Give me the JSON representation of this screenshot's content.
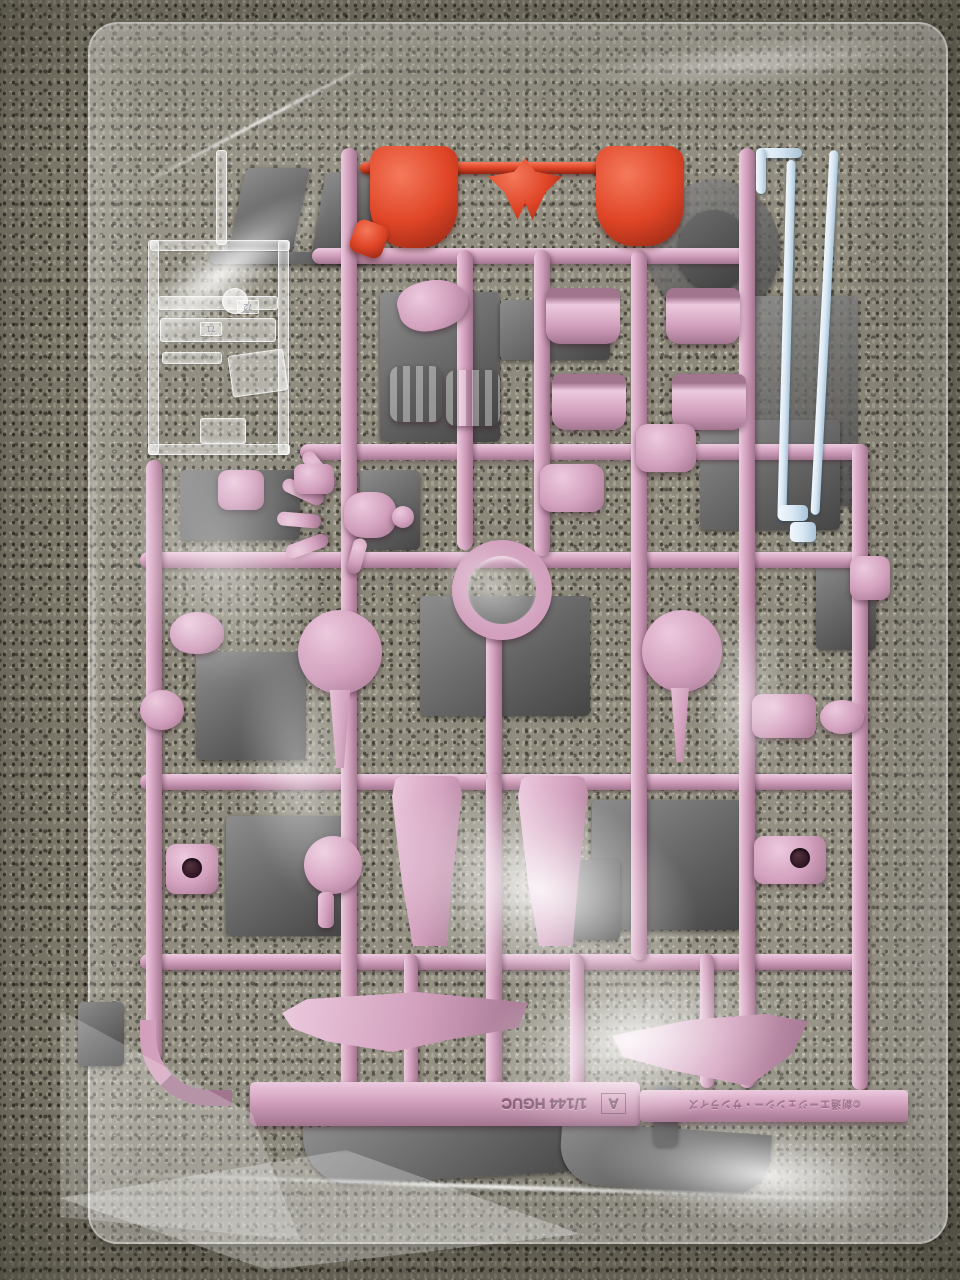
{
  "molded_text": {
    "runner_letter": "A",
    "scale_text": "1/144 HGUC",
    "copyright_text": "©創通エージェンシー・サンライズ"
  },
  "part_tags": {
    "clear_tag_1": "72",
    "clear_tag_2": "71"
  },
  "colors": {
    "carpet": "#837f70",
    "pink": "#d2a0bd",
    "pinkL": "#eccade",
    "pinkD": "#a2758f",
    "red": "#df4526",
    "redL": "#f5795c",
    "redD": "#8d2413",
    "blue": "#d9e8f4",
    "blueD": "#a9c3d7",
    "gray": "#646464",
    "grayD": "#454545",
    "grayL": "#8d8d8d"
  }
}
